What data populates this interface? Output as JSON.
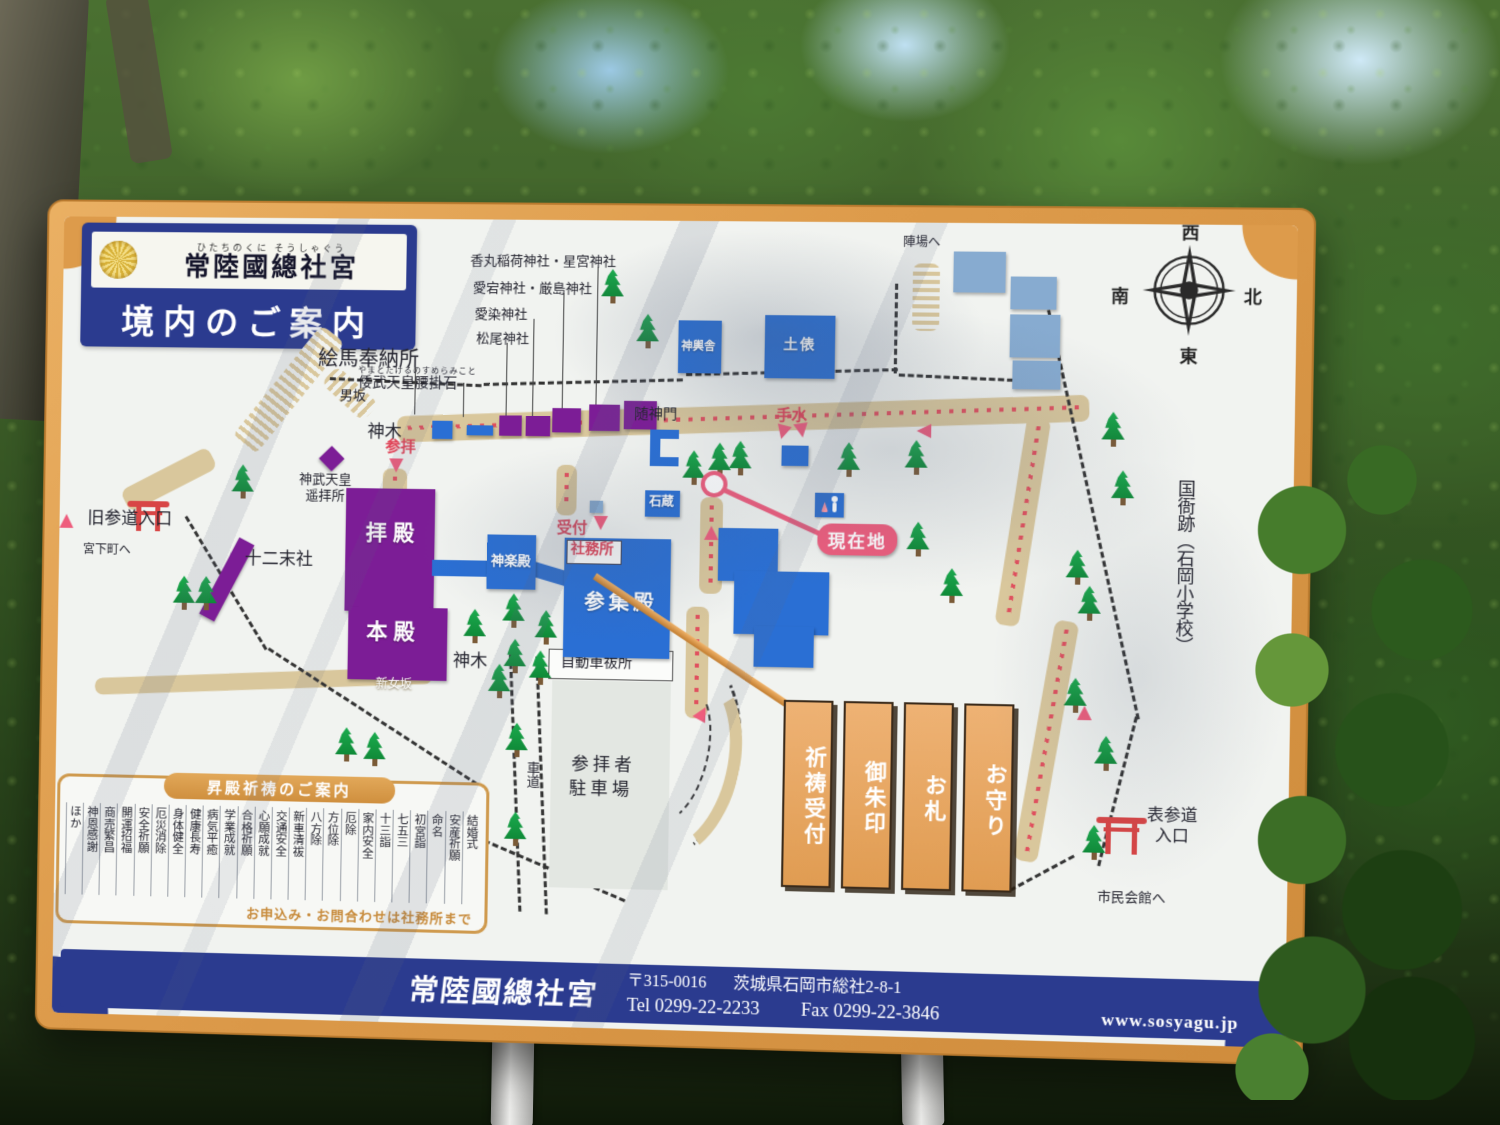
{
  "header": {
    "furigana": "ひたちのくに そうしゃぐう",
    "shrine_name": "常陸國總社宮",
    "map_title": "境内のご案内"
  },
  "sub_shrines": [
    "香丸稲荷神社・星宮神社",
    "愛宕神社・厳島神社",
    "愛染神社",
    "松尾神社"
  ],
  "landmarks": {
    "ema_hall": "絵馬奉納所",
    "stone_furigana": "やまとたけるのすめらみこと",
    "stone": "倭武天皇腰掛石",
    "otokozaka": "男坂",
    "sacred_tree_upper": "神木",
    "sanpai": "参拝",
    "jinmu_yohaisho": "神武天皇遥拝所",
    "old_approach": "旧参道入口",
    "miyashita": "宮下町へ",
    "junimassha": "十二末社",
    "haiden": "拝殿",
    "honden": "本殿",
    "kagura_den": "神楽殿",
    "sanshuden": "参集殿",
    "reception": "受付",
    "shamusho": "社務所",
    "zuishinmon": "随神門",
    "chozu": "手水",
    "ishigura": "石蔵",
    "mikoshiya": "神輿舎",
    "dohyo": "土俵",
    "jinba": "陣場へ",
    "current_location": "現在地",
    "sacred_tree_lower": "神木",
    "shinonnazaka": "新女坂",
    "car_purification": "自動車祓所",
    "parking_line1": "参拝者",
    "parking_line2": "駐車場",
    "roadway": "車道",
    "omote_sando": "表参道",
    "omote_sando2": "入口",
    "civic_hall": "市民会館へ",
    "kokuga_ruins": "国衙跡（石岡小学校）"
  },
  "compass": {
    "top": "西",
    "bottom": "東",
    "left": "南",
    "right": "北"
  },
  "banners": [
    "祈祷受付",
    "御朱印",
    "お札",
    "お守り"
  ],
  "prayer_box": {
    "title": "昇殿祈祷のご案内",
    "items": [
      "結婚式",
      "安産祈願",
      "命名",
      "初宮詣",
      "七五三",
      "十三詣",
      "家内安全",
      "厄除",
      "方位除",
      "八方除",
      "新車清祓",
      "交通安全",
      "心願成就",
      "合格祈願",
      "学業成就",
      "病気平癒",
      "健康長寿",
      "身体健全",
      "厄災消除",
      "安全祈願",
      "開運招福",
      "商売繁昌",
      "神恩感謝",
      "ほか"
    ],
    "footer": "お申込み・お問合わせは社務所まで"
  },
  "footer_band": {
    "shrine_name": "常陸國總社宮",
    "postal": "〒315-0016",
    "address": "茨城県石岡市総社2-8-1",
    "tel": "Tel 0299-22-2233",
    "fax": "Fax 0299-22-3846",
    "url": "www.sosyagu.jp"
  },
  "colors": {
    "frame_orange": "#dd9b4b",
    "navy": "#2b3b8f",
    "building_purple": "#7c1d96",
    "building_blue": "#2a6fd4",
    "building_lightblue": "#87abd0",
    "path_tan": "#d9c79c",
    "route_red": "#e0505e",
    "accent_pink": "#ee5d7d",
    "torii_red": "#d84545",
    "tree_green": "#149a44"
  }
}
